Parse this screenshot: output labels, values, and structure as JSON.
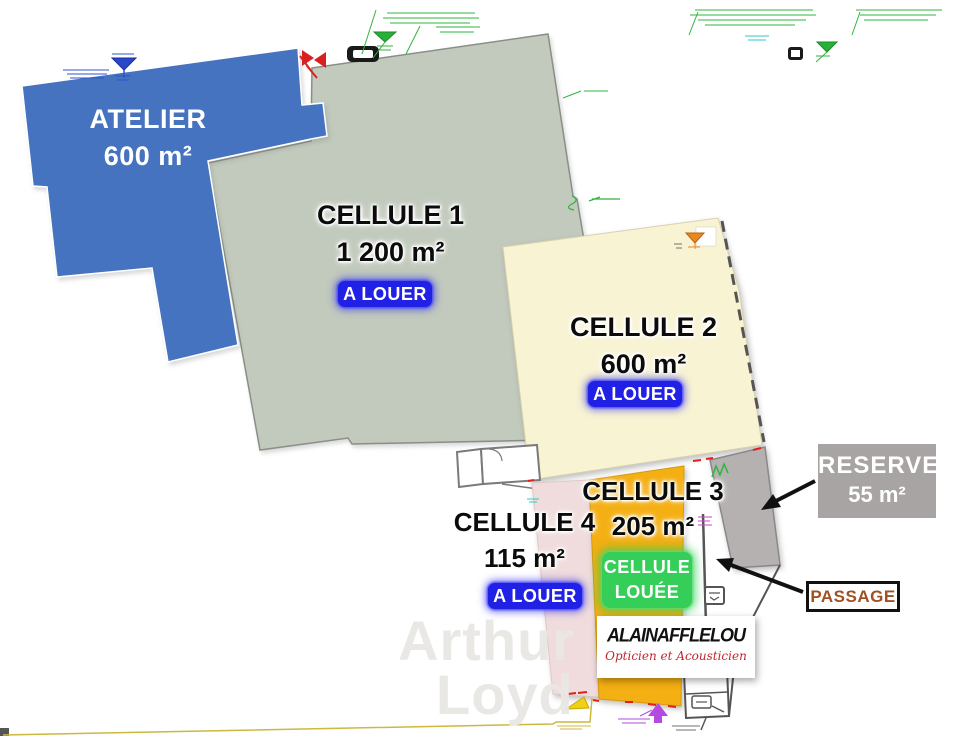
{
  "watermark": {
    "line1": "Arthur",
    "line2": "Loyd",
    "color": "#E9E7E4"
  },
  "zones": {
    "atelier": {
      "title": "ATELIER",
      "area": "600 m²",
      "fill": "#4573BF",
      "text_color": "#FFFFFF"
    },
    "cellule1": {
      "title": "CELLULE 1",
      "area": "1 200 m²",
      "fill": "#C2CABD",
      "status": "A LOUER"
    },
    "cellule2": {
      "title": "CELLULE 2",
      "area": "600 m²",
      "fill": "#F8F3D3",
      "status": "A LOUER"
    },
    "cellule3": {
      "title": "CELLULE 3",
      "area": "205 m²",
      "fill": "#F4AF12",
      "status_line1": "CELLULE",
      "status_line2": "LOUÉE",
      "status_color": "#35CE58"
    },
    "cellule4": {
      "title": "CELLULE 4",
      "area": "115 m²",
      "fill": "#F0DCDC",
      "status": "A LOUER"
    },
    "reserve": {
      "title": "RESERVE",
      "area": "55 m²",
      "fill": "#B5B1B0",
      "label_bg": "#A8A4A4"
    }
  },
  "badges": {
    "a_louer_bg": "#2121E6",
    "louee_bg": "#35CE58"
  },
  "callouts": {
    "passage": {
      "label": "PASSAGE",
      "text_color": "#A0511F"
    }
  },
  "logo": {
    "brand": "ALAINAFFLELOU",
    "tagline": "Opticien et Acousticien",
    "tagline_color": "#C2272E"
  },
  "annotations": {
    "colors": {
      "cad_green": "#2FB53C",
      "cad_cyan": "#2FC8C0",
      "cad_blue": "#3050D0",
      "cad_magenta": "#D040C0",
      "cad_purple": "#B44BE0",
      "cad_yellow": "#CDB93D",
      "cad_red": "#E02020"
    }
  }
}
